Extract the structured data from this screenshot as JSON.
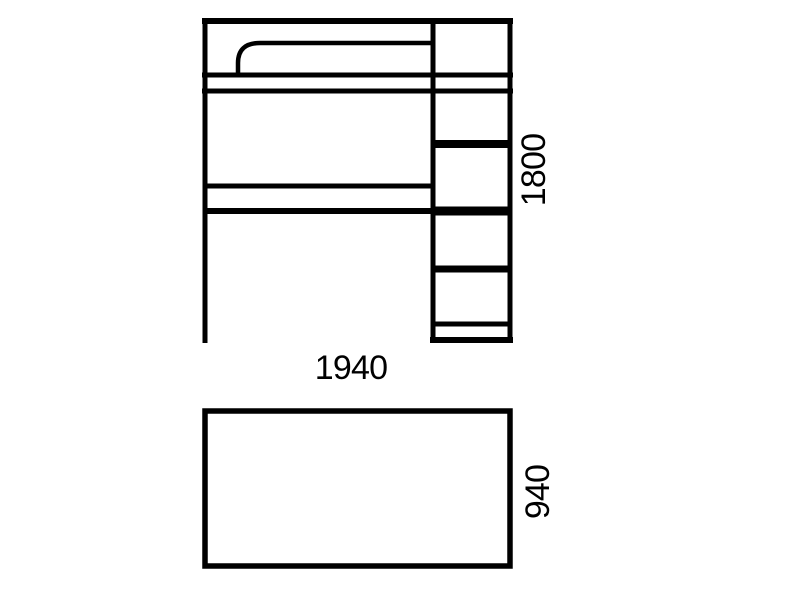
{
  "diagram": {
    "background_color": "#ffffff",
    "line_color": "#000000",
    "front_view": {
      "width_label": "1940",
      "height_label": "1800"
    },
    "plan_view": {
      "depth_label": "940"
    }
  }
}
